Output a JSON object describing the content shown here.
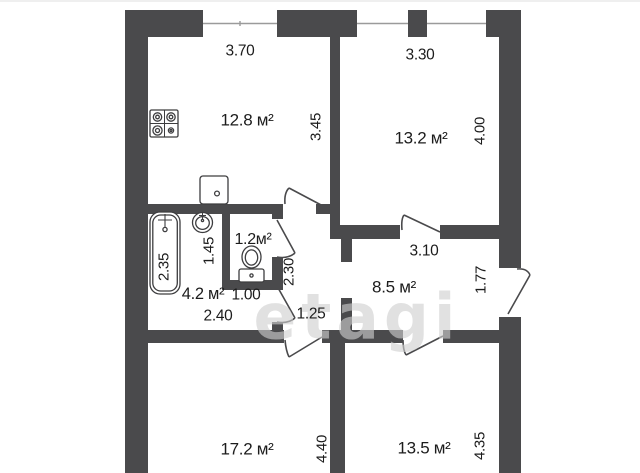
{
  "watermark": "etagi",
  "colors": {
    "wall": "#4a4a4c",
    "fixture_line": "#3d3d3f",
    "text": "#1c1c1c",
    "watermark": "#cfcfcf",
    "window_line": "#9b9b9b"
  },
  "rooms": {
    "kitchen": {
      "area": "12.8 м²",
      "width": "3.70",
      "height": "3.45"
    },
    "room_13_2": {
      "area": "13.2 м²",
      "width": "3.30",
      "height": "4.00"
    },
    "wc": {
      "area": "1.2м²",
      "width": "1.00"
    },
    "bathroom": {
      "area": "4.2 м²",
      "width": "2.40",
      "height": "2.35",
      "inner_height": "1.45"
    },
    "corridor": {
      "width": "1.25",
      "height": "2.30"
    },
    "hallway": {
      "area": "8.5 м²",
      "width": "3.10",
      "height": "1.77"
    },
    "room_17_2": {
      "area": "17.2 м²",
      "height": "4.40"
    },
    "room_13_5": {
      "area": "13.5 м²",
      "height": "4.35"
    }
  },
  "fixtures": [
    "stove",
    "kitchen-sink",
    "washbasin",
    "bathtub",
    "toilet"
  ]
}
